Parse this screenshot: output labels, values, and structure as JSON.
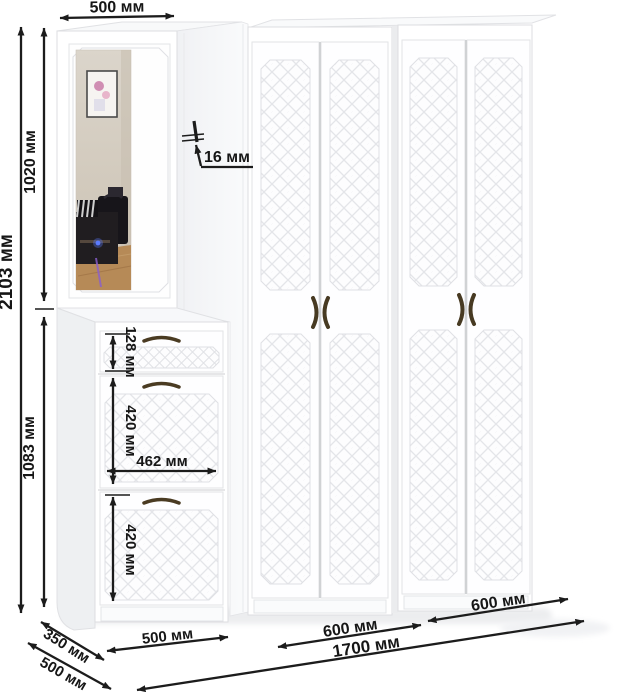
{
  "diagram": {
    "kind": "furniture-dimension-diagram",
    "unit_note": "all labels as rendered, Russian millimetre abbreviation"
  },
  "dimensions": {
    "top_width": "500 мм",
    "total_height": "2103 мм",
    "upper_section_height": "1020 мм",
    "lower_section_height": "1083 мм",
    "panel_thickness": "16 мм",
    "drawer_height": "128 мм",
    "flap1_height": "420 мм",
    "flap_width": "462 мм",
    "flap2_height": "420 мм",
    "shoe_cabinet_width": "500 мм",
    "wardrobe1_width": "600 мм",
    "wardrobe2_width": "600 мм",
    "total_width": "1700 мм",
    "shoe_cabinet_depth": "350 мм",
    "wardrobe_depth": "500 мм"
  },
  "colors": {
    "dimension_ink": "#1c1c1c",
    "furniture_white": "#ffffff",
    "panel_outline": "#dcdde0",
    "handle_bronze": "#473a22",
    "mirror_wall": "#d5cec4",
    "mirror_floor": "#b68a57",
    "reflection_dark": "#1f1c20",
    "led_blue": "#5b7bff"
  }
}
